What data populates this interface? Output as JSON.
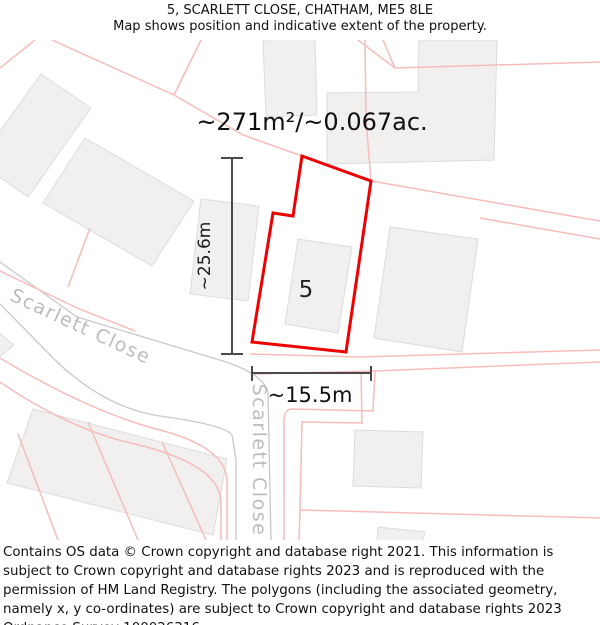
{
  "header": {
    "title": "5, SCARLETT CLOSE, CHATHAM, ME5 8LE",
    "subtitle": "Map shows position and indicative extent of the property."
  },
  "map": {
    "area_label": "~271m²/~0.067ac.",
    "plot_number": "5",
    "height_label": "~25.6m",
    "width_label": "~15.5m",
    "street_label_diagonal": "Scarlett Close",
    "street_label_vertical": "Scarlett Close",
    "colors": {
      "property_outline": "#ee0000",
      "parcel_line": "#f6bcbc",
      "road_edge": "#c9c9c9",
      "building_fill": "#f1f0ef",
      "building_stroke": "#dcdcdc",
      "street_label": "#bcbcbc",
      "measurement": "#4a4a4a"
    }
  },
  "footer": {
    "text": "Contains OS data © Crown copyright and database right 2021. This information is subject to Crown copyright and database rights 2023 and is reproduced with the permission of HM Land Registry. The polygons (including the associated geometry, namely x, y co-ordinates) are subject to Crown copyright and database rights 2023 Ordnance Survey 100026316."
  }
}
